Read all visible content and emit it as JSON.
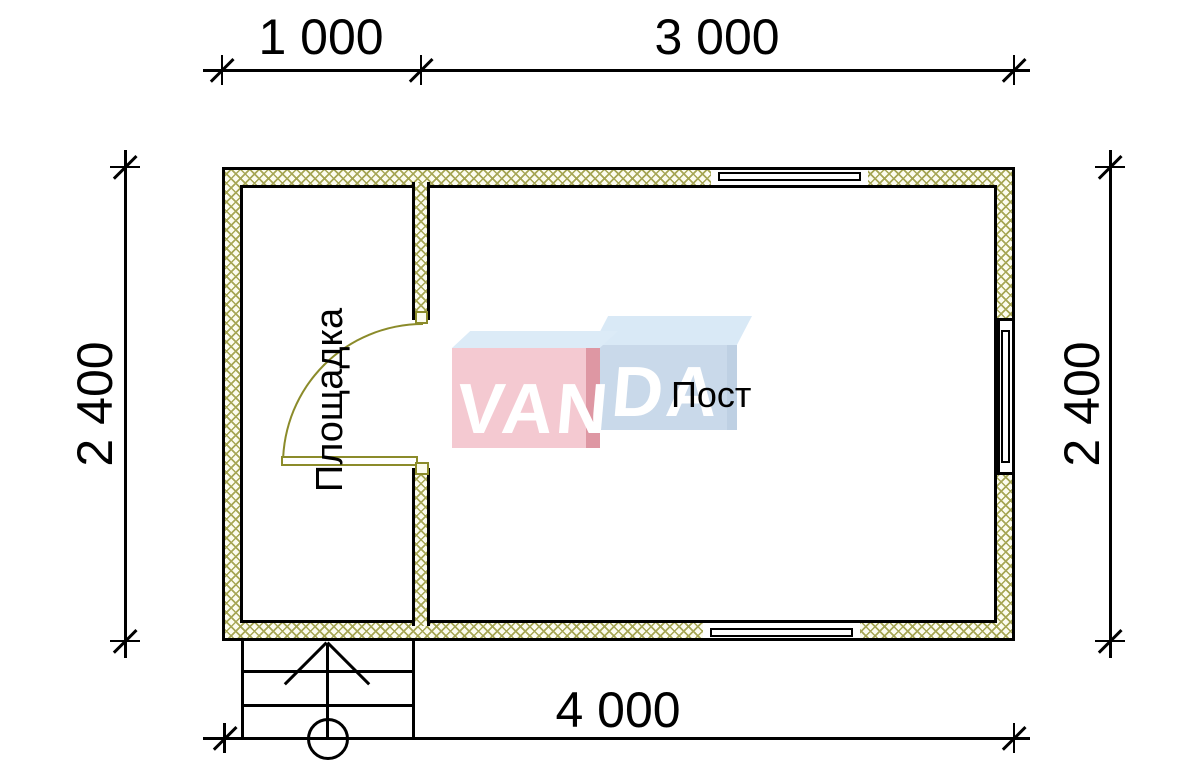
{
  "dimensions": {
    "top_left_segment": "1 000",
    "top_right_segment": "3 000",
    "left_height": "2 400",
    "right_height": "2 400",
    "bottom_total": "4 000"
  },
  "rooms": {
    "platform": "Площадка",
    "post": "Пост"
  },
  "watermark": {
    "text_left": "VAN",
    "text_right": "DA"
  },
  "colors": {
    "line": "#000000",
    "wall_hatch": "#a6a655",
    "wall_fill": "#fcfcef",
    "door": "#8b8b2a",
    "watermark_pink": "#f4c9d1",
    "watermark_pink_dark": "#de97a3",
    "watermark_blue": "#c9d9ea",
    "watermark_blue_light": "#d9e9f6"
  }
}
